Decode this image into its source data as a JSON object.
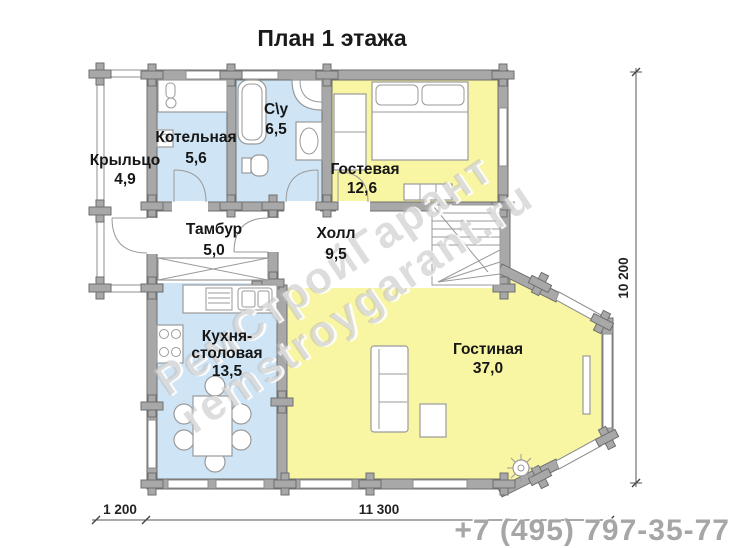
{
  "title": "План 1 этажа",
  "phone": "+7 (495) 797-35-77",
  "watermark": {
    "line1": "РемСтройГарант",
    "line2": "remstroygarant.ru"
  },
  "dimensions": {
    "vertical": "10 200",
    "bottom_left": "1 200",
    "bottom_main": "11 300"
  },
  "colors": {
    "room_blue": "#cfe5f6",
    "room_yellow": "#f8f5a3",
    "wall_gray": "#a8a8a8",
    "wall_edge": "#6e6e6e",
    "phone_gray": "#a6a6a6"
  },
  "rooms": {
    "porch": {
      "name": "Крыльцо",
      "area": "4,9"
    },
    "boiler": {
      "name": "Котельная",
      "area": "5,6"
    },
    "bathroom": {
      "name": "С\\у",
      "area": "6,5"
    },
    "guest": {
      "name": "Гостевая",
      "area": "12,6"
    },
    "tambour": {
      "name": "Тамбур",
      "area": "5,0"
    },
    "hall": {
      "name": "Холл",
      "area": "9,5"
    },
    "kitchen": {
      "name_line1": "Кухня-",
      "name_line2": "столовая",
      "area": "13,5"
    },
    "living": {
      "name": "Гостиная",
      "area": "37,0"
    }
  }
}
